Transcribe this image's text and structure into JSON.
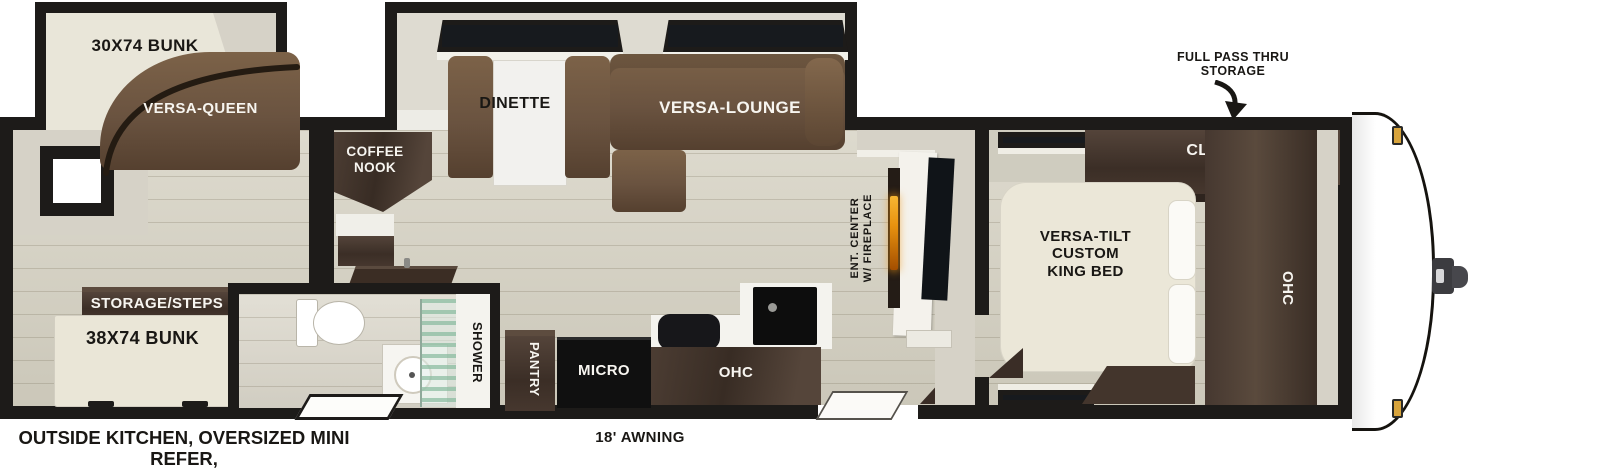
{
  "labels": {
    "bunk30": "30X74 BUNK",
    "versa_queen": "VERSA-QUEEN",
    "dinette": "DINETTE",
    "versa_lounge": "VERSA-LOUNGE",
    "coffee_nook_line1": "COFFEE",
    "coffee_nook_line2": "NOOK",
    "storage_steps": "STORAGE/STEPS",
    "bunk38": "38X74 BUNK",
    "shower": "SHOWER",
    "pantry": "PANTRY",
    "micro": "MICRO",
    "ohc_kitchen": "OHC",
    "ent_center_line1": "ENT. CENTER",
    "ent_center_line2": "W/ FIREPLACE",
    "closet": "CLOSET",
    "king_bed_line1": "VERSA-TILT",
    "king_bed_line2": "CUSTOM",
    "king_bed_line3": "KING BED",
    "ohc_bedroom": "OHC"
  },
  "annotations": {
    "full_pass_line1": "FULL PASS THRU",
    "full_pass_line2": "STORAGE",
    "awning": "18' AWNING",
    "outside_line1": "OUTSIDE KITCHEN, OVERSIZED MINI REFER,",
    "outside_line2": "SINK"
  },
  "colors": {
    "wall": "#1d1b19",
    "floor": "#d6d2c3",
    "wood_dark": "#46382f",
    "sofa_brown": "#6e5640",
    "bed_cream": "#ebe7d8",
    "fireplace_orange": "#e8920f",
    "clearance_light_gold": "#d8a43c",
    "shower_glass_green": "#a8cbb8"
  }
}
